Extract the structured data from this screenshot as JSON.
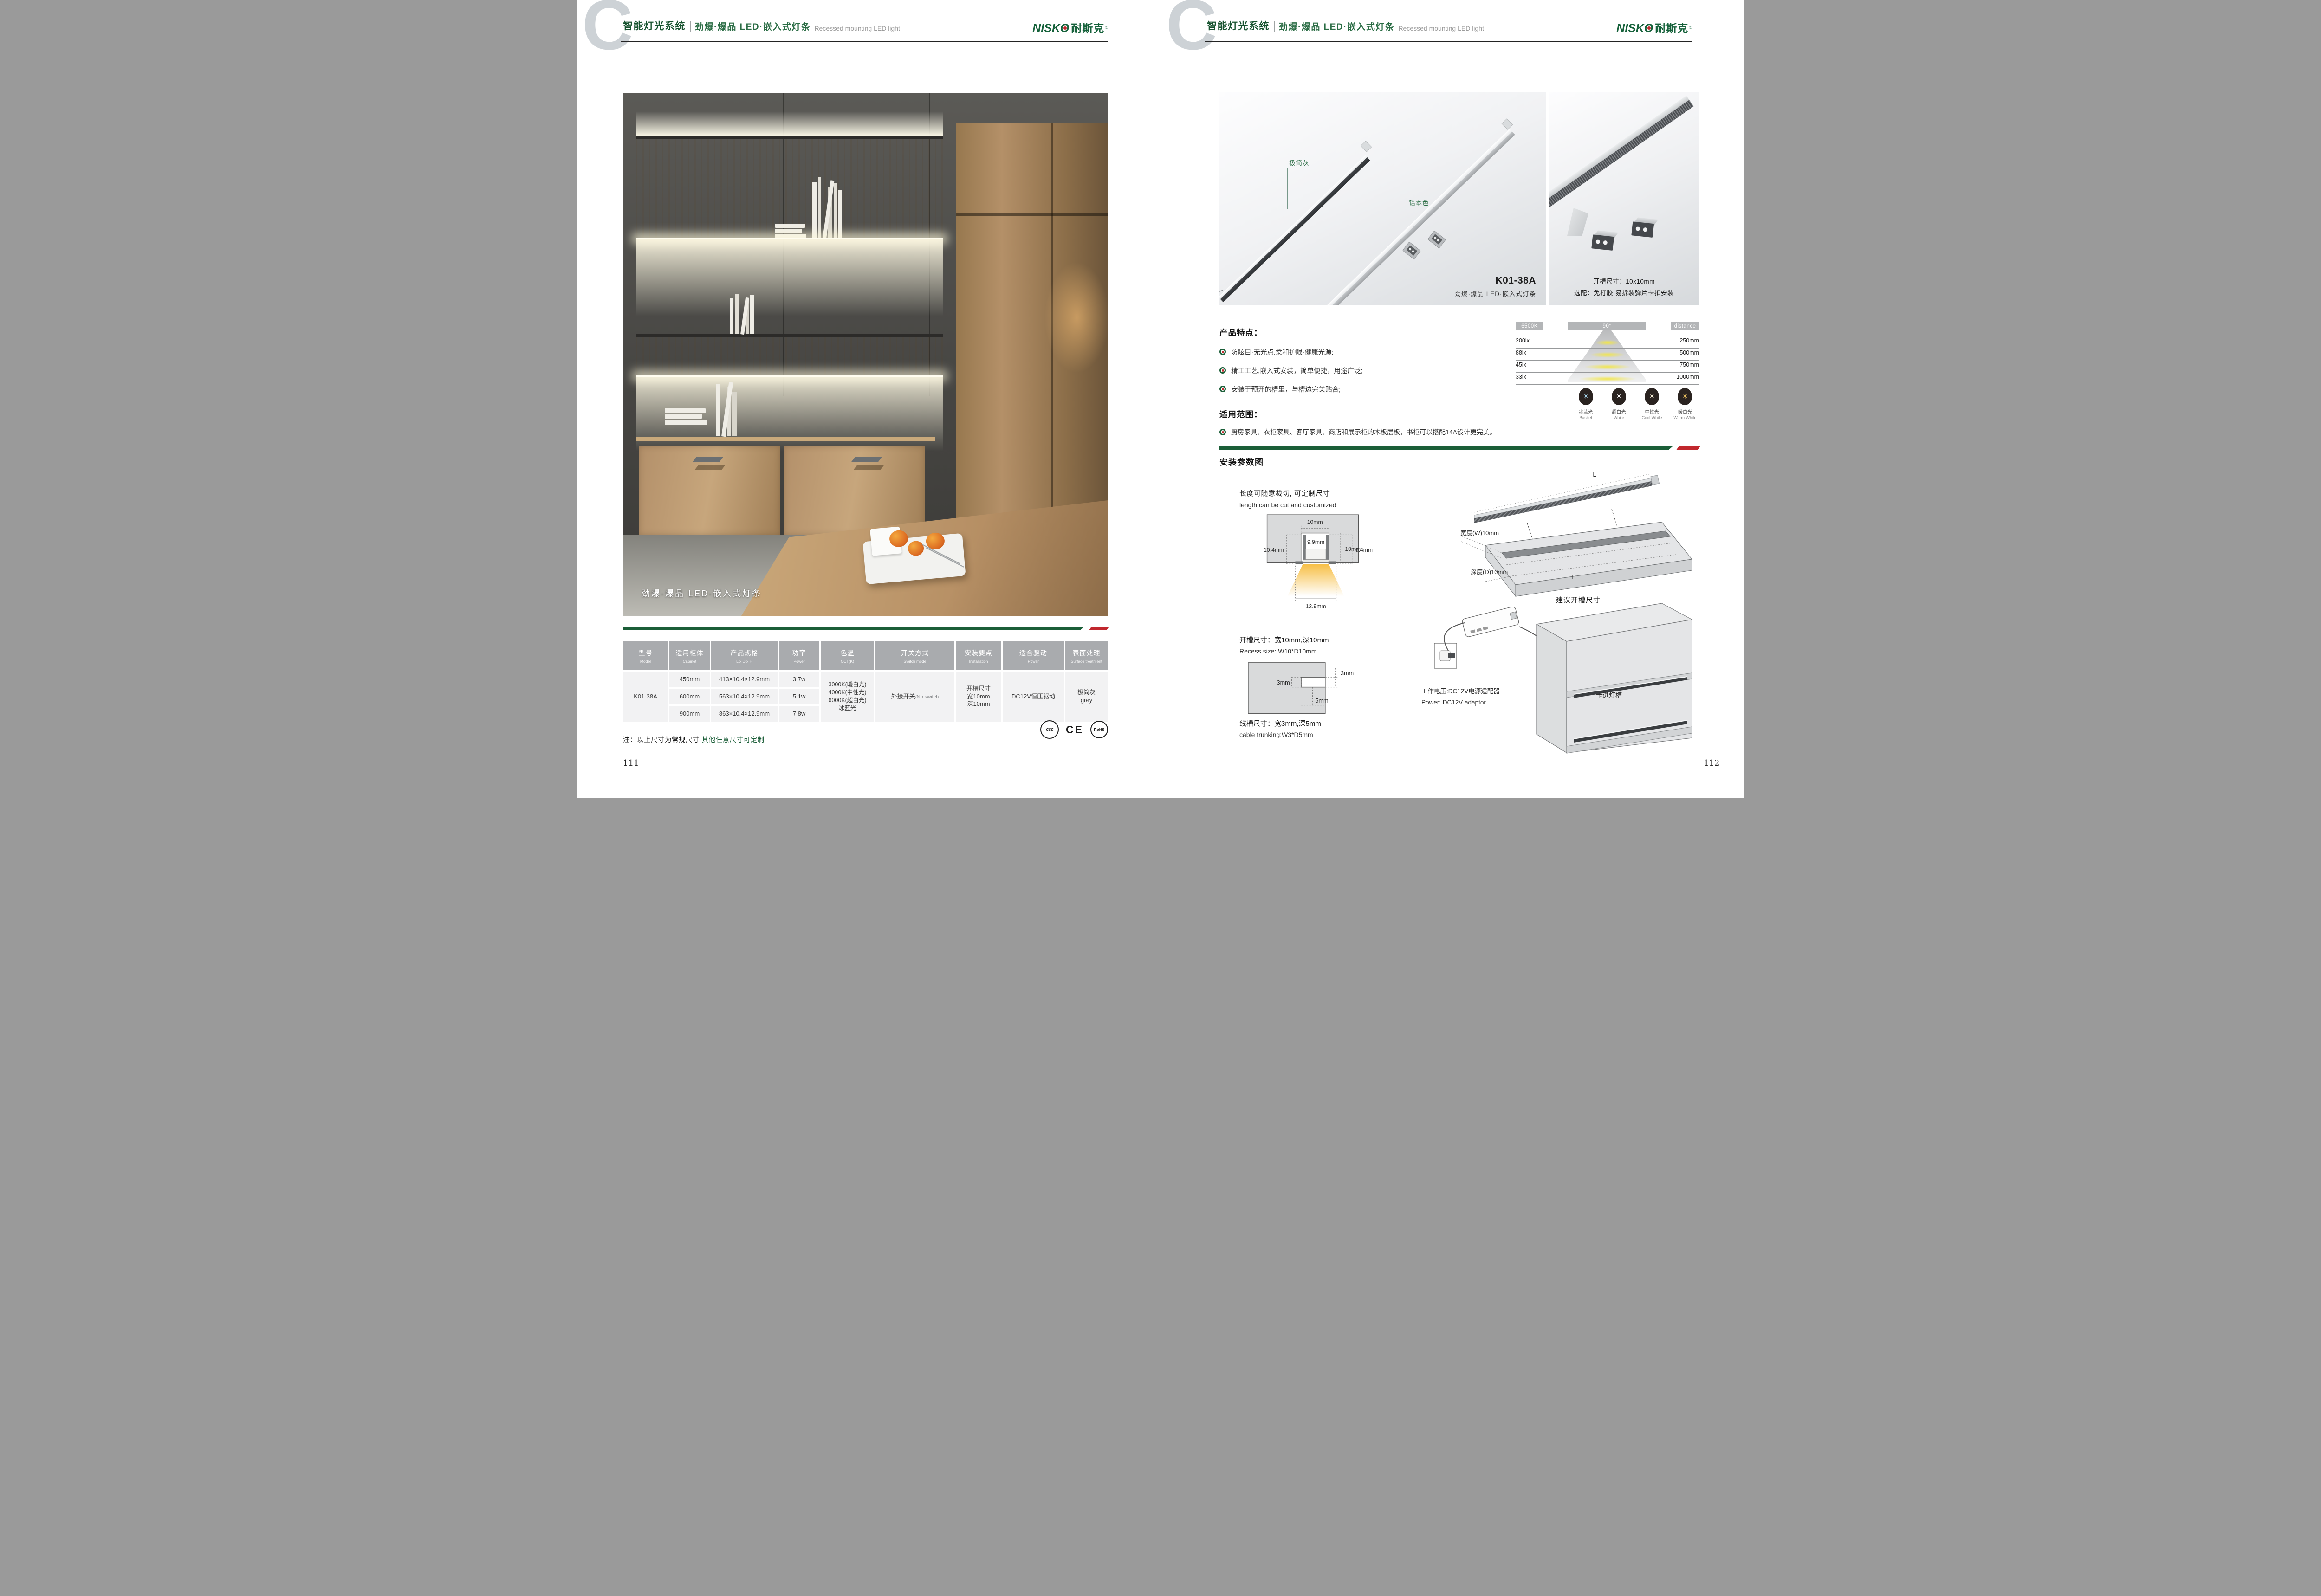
{
  "brand": {
    "latin": "NISKO",
    "zh": "耐斯克",
    "reg": "®"
  },
  "header": {
    "watermark": "C",
    "system": "智能灯光系统",
    "subtitle_zh": "劲爆·爆品  LED·嵌入式灯条",
    "subtitle_en": "Recessed mounting LED light"
  },
  "colors": {
    "green": "#1b5e38",
    "red": "#c1272d",
    "table_header_bg": "#a9abae",
    "table_cell_bg": "#f2f2f3"
  },
  "page_left": {
    "photo_caption": "劲爆·爆品  LED·嵌入式灯条",
    "table": {
      "headers": [
        {
          "zh": "型号",
          "en": "Model"
        },
        {
          "zh": "适用柜体",
          "en": "Cabinet"
        },
        {
          "zh": "产品规格",
          "en": "L x D x H"
        },
        {
          "zh": "功率",
          "en": "Power"
        },
        {
          "zh": "色温",
          "en": "CCT(K)"
        },
        {
          "zh": "开关方式",
          "en": "Switch mode"
        },
        {
          "zh": "安装要点",
          "en": "Installation"
        },
        {
          "zh": "适合驱动",
          "en": "Power"
        },
        {
          "zh": "表面处理",
          "en": "Surface treatment"
        }
      ],
      "model": "K01-38A",
      "rows": [
        {
          "cabinet": "450mm",
          "spec": "413×10.4×12.9mm",
          "power": "3.7w"
        },
        {
          "cabinet": "600mm",
          "spec": "563×10.4×12.9mm",
          "power": "5.1w"
        },
        {
          "cabinet": "900mm",
          "spec": "863×10.4×12.9mm",
          "power": "7.8w"
        }
      ],
      "cct": [
        "3000K(暖白光)",
        "4000K(中性光)",
        "6000K(超白光)",
        "冰蓝光"
      ],
      "switch_zh": "外接开关",
      "switch_en": "/No switch",
      "install": [
        "开槽尺寸",
        "宽10mm",
        "深10mm"
      ],
      "driver": "DC12V恒压驱动",
      "surface": [
        "极简灰",
        "grey"
      ]
    },
    "note_prefix": "注：以上尺寸为常规尺寸 ",
    "note_highlight": "其他任意尺寸可定制",
    "certs": {
      "ccc": "ccc",
      "ce": "CE",
      "rohs": "RoHS"
    },
    "page_no": "111"
  },
  "page_right": {
    "photo1": {
      "label_gray": "极简灰",
      "label_alu": "铝本色",
      "model": "K01-38A",
      "model_sub": "劲爆·爆品  LED·嵌入式灯条"
    },
    "photo2": {
      "line1": "开槽尺寸：10x10mm",
      "line2": "选配：免打胶·易拆装弹片卡扣安装"
    },
    "features": {
      "title": "产品特点：",
      "items": [
        "防眩目·无光点,柔和护眼·健康光源;",
        "精工工艺,嵌入式安装，简单便捷，用途广泛;",
        "安装于预开的槽里，与槽边完美贴合;"
      ]
    },
    "light_chart": {
      "cct": "6500K",
      "angle": "90°",
      "distance": "distance",
      "rows": [
        {
          "lux": "200lx",
          "dist": "250mm"
        },
        {
          "lux": "88lx",
          "dist": "500mm"
        },
        {
          "lux": "45lx",
          "dist": "750mm"
        },
        {
          "lux": "33lx",
          "dist": "1000mm"
        }
      ]
    },
    "scope": {
      "title": "适用范围：",
      "item": "厨房家具、衣柜家具、客厅家具、商店和展示柜的木板层板，书柜可以搭配14A设计更完美。"
    },
    "cct_icons": [
      {
        "zh": "冰蓝光",
        "en": "Basket",
        "color": "#a9d9f1"
      },
      {
        "zh": "超白光",
        "en": "White",
        "color": "#ffffff"
      },
      {
        "zh": "中性光",
        "en": "Cool White",
        "color": "#f6eed6"
      },
      {
        "zh": "暖白光",
        "en": "Warm White",
        "color": "#f0c461"
      }
    ],
    "install": {
      "title": "安装参数图",
      "cut_zh": "长度可随意裁切, 可定制尺寸",
      "cut_en": "length can be cut and customized",
      "dims": {
        "top": "10mm",
        "side": "10mm",
        "inner": "9.9mm",
        "left": "10.4mm",
        "right": "9.4mm",
        "bottom": "12.9mm"
      },
      "recess_zh": "开槽尺寸：宽10mm,深10mm",
      "recess_en": "Recess size: W10*D10mm",
      "notch": {
        "a": "3mm",
        "b": "3mm",
        "c": "5mm"
      },
      "cable_zh": "线槽尺寸：宽3mm,深5mm",
      "cable_en": "cable trunking:W3*D5mm",
      "board": {
        "l1": "L",
        "l2": "L",
        "width": "宽度(W)10mm",
        "depth": "深度(D)10mm",
        "caption": "建议开槽尺寸"
      },
      "power_zh": "工作电压:DC12V电源适配器",
      "power_en": "Power: DC12V adaptor",
      "clip_label": "卡进灯槽"
    },
    "page_no": "112"
  }
}
